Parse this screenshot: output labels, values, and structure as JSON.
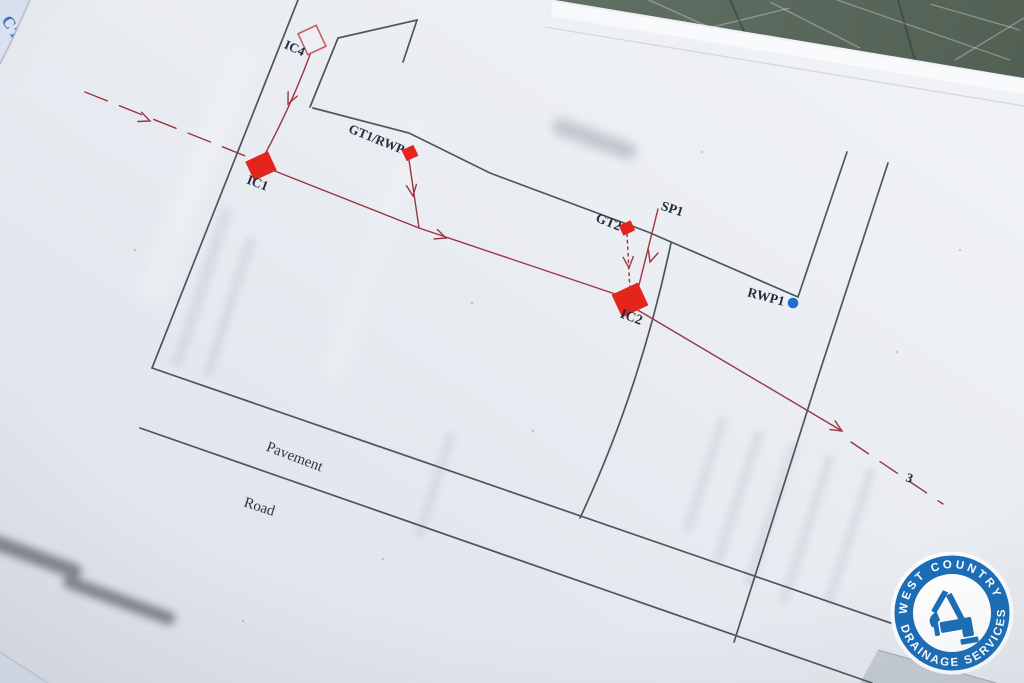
{
  "plan_labels": {
    "ic4": "IC4",
    "ic1": "IC1",
    "gt1_rwp": "GT1/RWP",
    "gt2": "GT2",
    "sp1": "SP1",
    "ic2": "IC2",
    "rwp1": "RWP1",
    "pavement": "Pavement",
    "road": "Road",
    "flow_marker": "3"
  },
  "underlying_sheet": {
    "fragment_line1": "C D",
    "fragment_line2": "Drain E"
  },
  "logo": {
    "arc_top": "WEST COUNTRY",
    "arc_bottom": "DRAINAGE SERVICES"
  },
  "colors": {
    "marker_red": "#e3251c",
    "pipe_red": "#9b3540",
    "plan_line": "#3e4a50",
    "rwp_blue": "#1c6ed2",
    "logo_blue": "#1a6db8",
    "sheet_text_blue": "#3f72bd",
    "table_green": "#5f6e62",
    "paper": "#e9ecf1"
  }
}
